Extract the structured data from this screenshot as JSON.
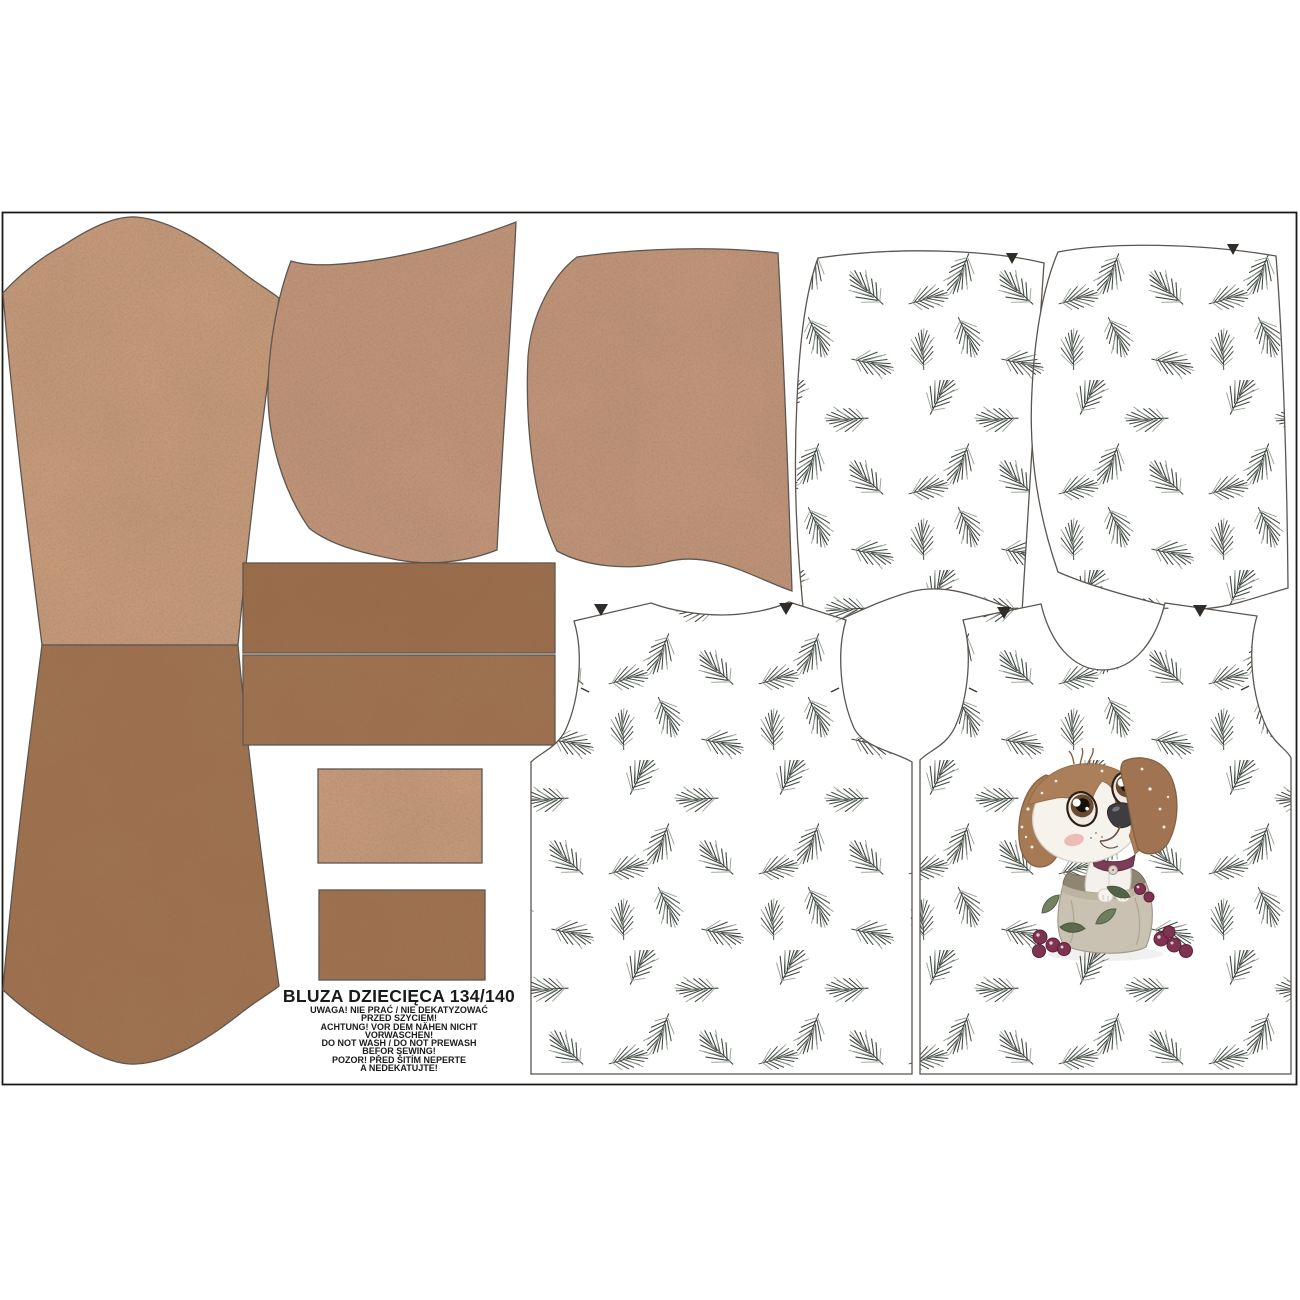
{
  "header": {
    "title": "BLUZA DZIECIĘCA 134/140"
  },
  "care_warnings": [
    "UWAGA! NIE PRAĆ / NIE DEKATYZOWAĆ",
    "PRZED SZYCIEM!",
    "ACHTUNG! VOR DEM NÄHEN NICHT",
    "VORWASCHEN!",
    "DO NOT WASH / DO NOT PREWASH",
    "BEFOR SEWING!",
    "POZOR! PŘED ŠITÍM NEPERTE",
    "A NEDEKATUJTE!"
  ],
  "colors": {
    "page_bg": "#ffffff",
    "border": "#1d1b19",
    "outline": "#5a554f",
    "tan_light": "#c59a7b",
    "tan_hood": "#c0947a",
    "brown_dark": "#9e714f",
    "brown_waistband": "#9a6c4a",
    "pine_dark": "#404740",
    "pine_light": "#97a097",
    "text": "#1a1a1a",
    "dog_ear_brown": "#a57a55",
    "dog_face_white": "#f6f2ec",
    "collar_maroon": "#7b3d55",
    "sack_beige": "#c9c1b2",
    "berry_burgundy": "#7e3350",
    "holly_green": "#6e7d5e"
  },
  "pieces": [
    {
      "name": "sleeve-upper",
      "fabric": "plain tan"
    },
    {
      "name": "sleeve-lower",
      "fabric": "plain brown"
    },
    {
      "name": "hood-side-left-tan",
      "fabric": "plain tan"
    },
    {
      "name": "hood-side-right-tan",
      "fabric": "plain tan"
    },
    {
      "name": "waistband-double",
      "fabric": "plain brown"
    },
    {
      "name": "cuff-upper",
      "fabric": "plain tan"
    },
    {
      "name": "cuff-lower",
      "fabric": "plain brown"
    },
    {
      "name": "hood-side-left-pine",
      "fabric": "pine sprigs on white"
    },
    {
      "name": "hood-side-right-pine",
      "fabric": "pine sprigs on white"
    },
    {
      "name": "back-panel",
      "fabric": "pine sprigs on white"
    },
    {
      "name": "front-panel",
      "fabric": "pine sprigs on white with puppy-in-sack motif"
    }
  ]
}
